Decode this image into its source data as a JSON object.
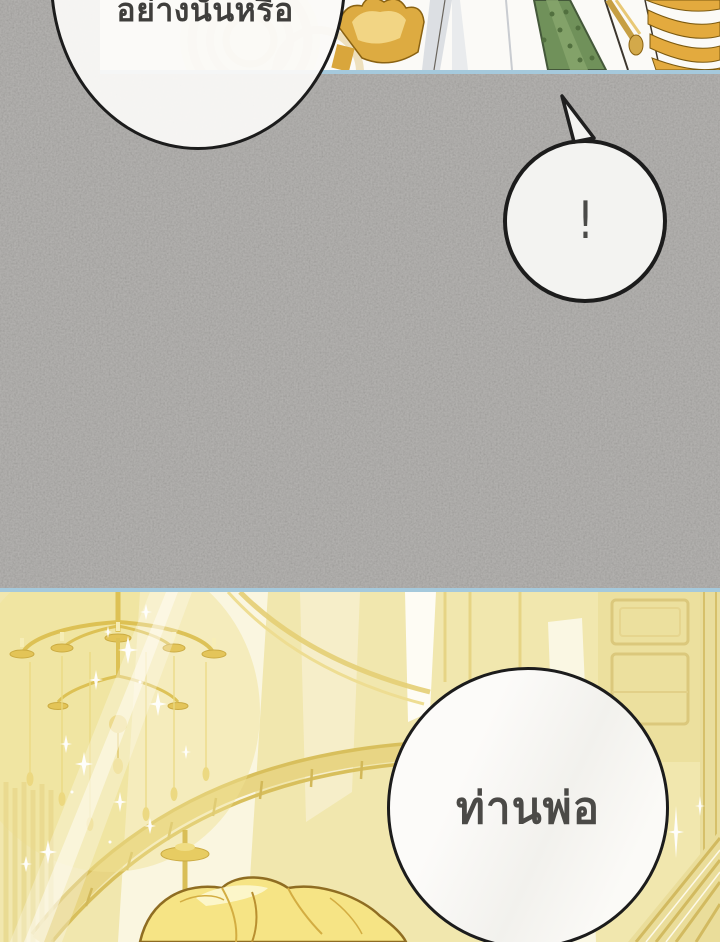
{
  "page": {
    "width": 720,
    "height": 942,
    "kind": "webtoon comic page (Thai)"
  },
  "speech_bubbles": {
    "question": {
      "text": "อย่างนั้นหรือ"
    },
    "exclamation": {
      "text": "!"
    },
    "father": {
      "text": "ท่านพ่อ"
    }
  },
  "colors": {
    "gray_panel": "#a7a5a2",
    "panel_border_blue": "#a5c9dc",
    "bubble_fill": "#fbfaf8",
    "bubble_outline": "#1c1c1c",
    "text_dark": "#3f3e3c",
    "palace_gold_base": "#f1e7ae",
    "gold_band": "#e3aa3e",
    "sash_green": "#70915a",
    "hair_blonde": "#f6e485"
  }
}
